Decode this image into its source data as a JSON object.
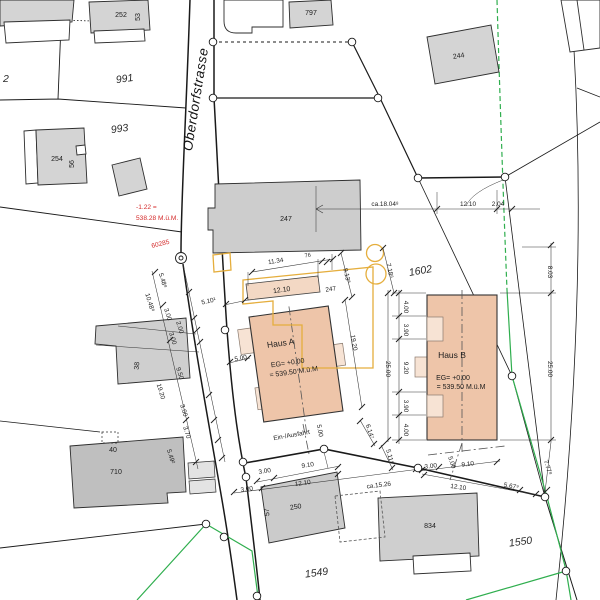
{
  "street": {
    "name": "Oberdorfstrasse"
  },
  "parcels": {
    "p2": "2",
    "p991": "991",
    "p993": "993",
    "p1602": "1602",
    "p1549": "1549",
    "p1550": "1550"
  },
  "buildings": {
    "b252": "252",
    "b252_no": "53",
    "b797": "797",
    "b244": "244",
    "b254": "254",
    "b254_no": "56",
    "b247": "247",
    "b247_rest": "247",
    "b38": "38",
    "b40": "40",
    "b710": "710",
    "b250": "250",
    "b250_no": "57",
    "b834": "834"
  },
  "haus_a": {
    "name": "Haus A",
    "eg": "EG= +0.00",
    "level": "= 539.50 M.ü.M"
  },
  "haus_b": {
    "name": "Haus B",
    "eg": "EG= +0.00",
    "level": "= 539.50 M.ü.M"
  },
  "red_marks": {
    "delta": "-1.22 =",
    "elevation": "538.28 M.ü.M.",
    "point_id": "60285"
  },
  "access": {
    "label": "Ein-/Ausfahrt"
  },
  "dims": {
    "top_ca": "ca.18.04⁸",
    "top_1210": "12.10",
    "top_204": "2.04",
    "u_1134": "11.34",
    "u_76": "76",
    "u_913": "9.13⁸",
    "u_718": "7.18⁶",
    "garage_1210": "12.10",
    "garage_247": "247",
    "r_803": "8.03",
    "r_2500": "25.00",
    "hb_2500": "25.00",
    "ha_1920": "19.20",
    "left_chain": [
      "5.48⁸",
      "10.48⁸",
      "3.00",
      "2.00",
      "3.00",
      "9.50",
      "19.20",
      "3.00",
      "3.70",
      "5.49²"
    ],
    "hb_chain": [
      "4.00",
      "3.90",
      "9.20",
      "3.90",
      "4.00"
    ],
    "road_510": "5.10¹",
    "road_500": "5.00",
    "ha_axis_500": "5.00",
    "a_614": "6.14⁷",
    "a_511": "5.11⁹",
    "sa_300u": "3.00",
    "sa_910": "9.10",
    "sa_300l": "3.00",
    "sa_1210": "12.10",
    "sa_ca1526": "ca.15.26",
    "sb_300": "3.00",
    "sb_500": "5.00",
    "sb_910": "9.10",
    "sb_1210": "12.10",
    "sb_567": "5.67⁹",
    "sb_777": "7.77⁸"
  },
  "colors": {
    "new_building": "#eec5a9",
    "balcony": "#f7e3d4",
    "garage": "#f3d8c4",
    "existing_building": "#d4d4d4",
    "envelope_yellow": "#e5ae3d",
    "boundary_green": "#2fae4e",
    "annotation_red": "#d42b2b"
  }
}
